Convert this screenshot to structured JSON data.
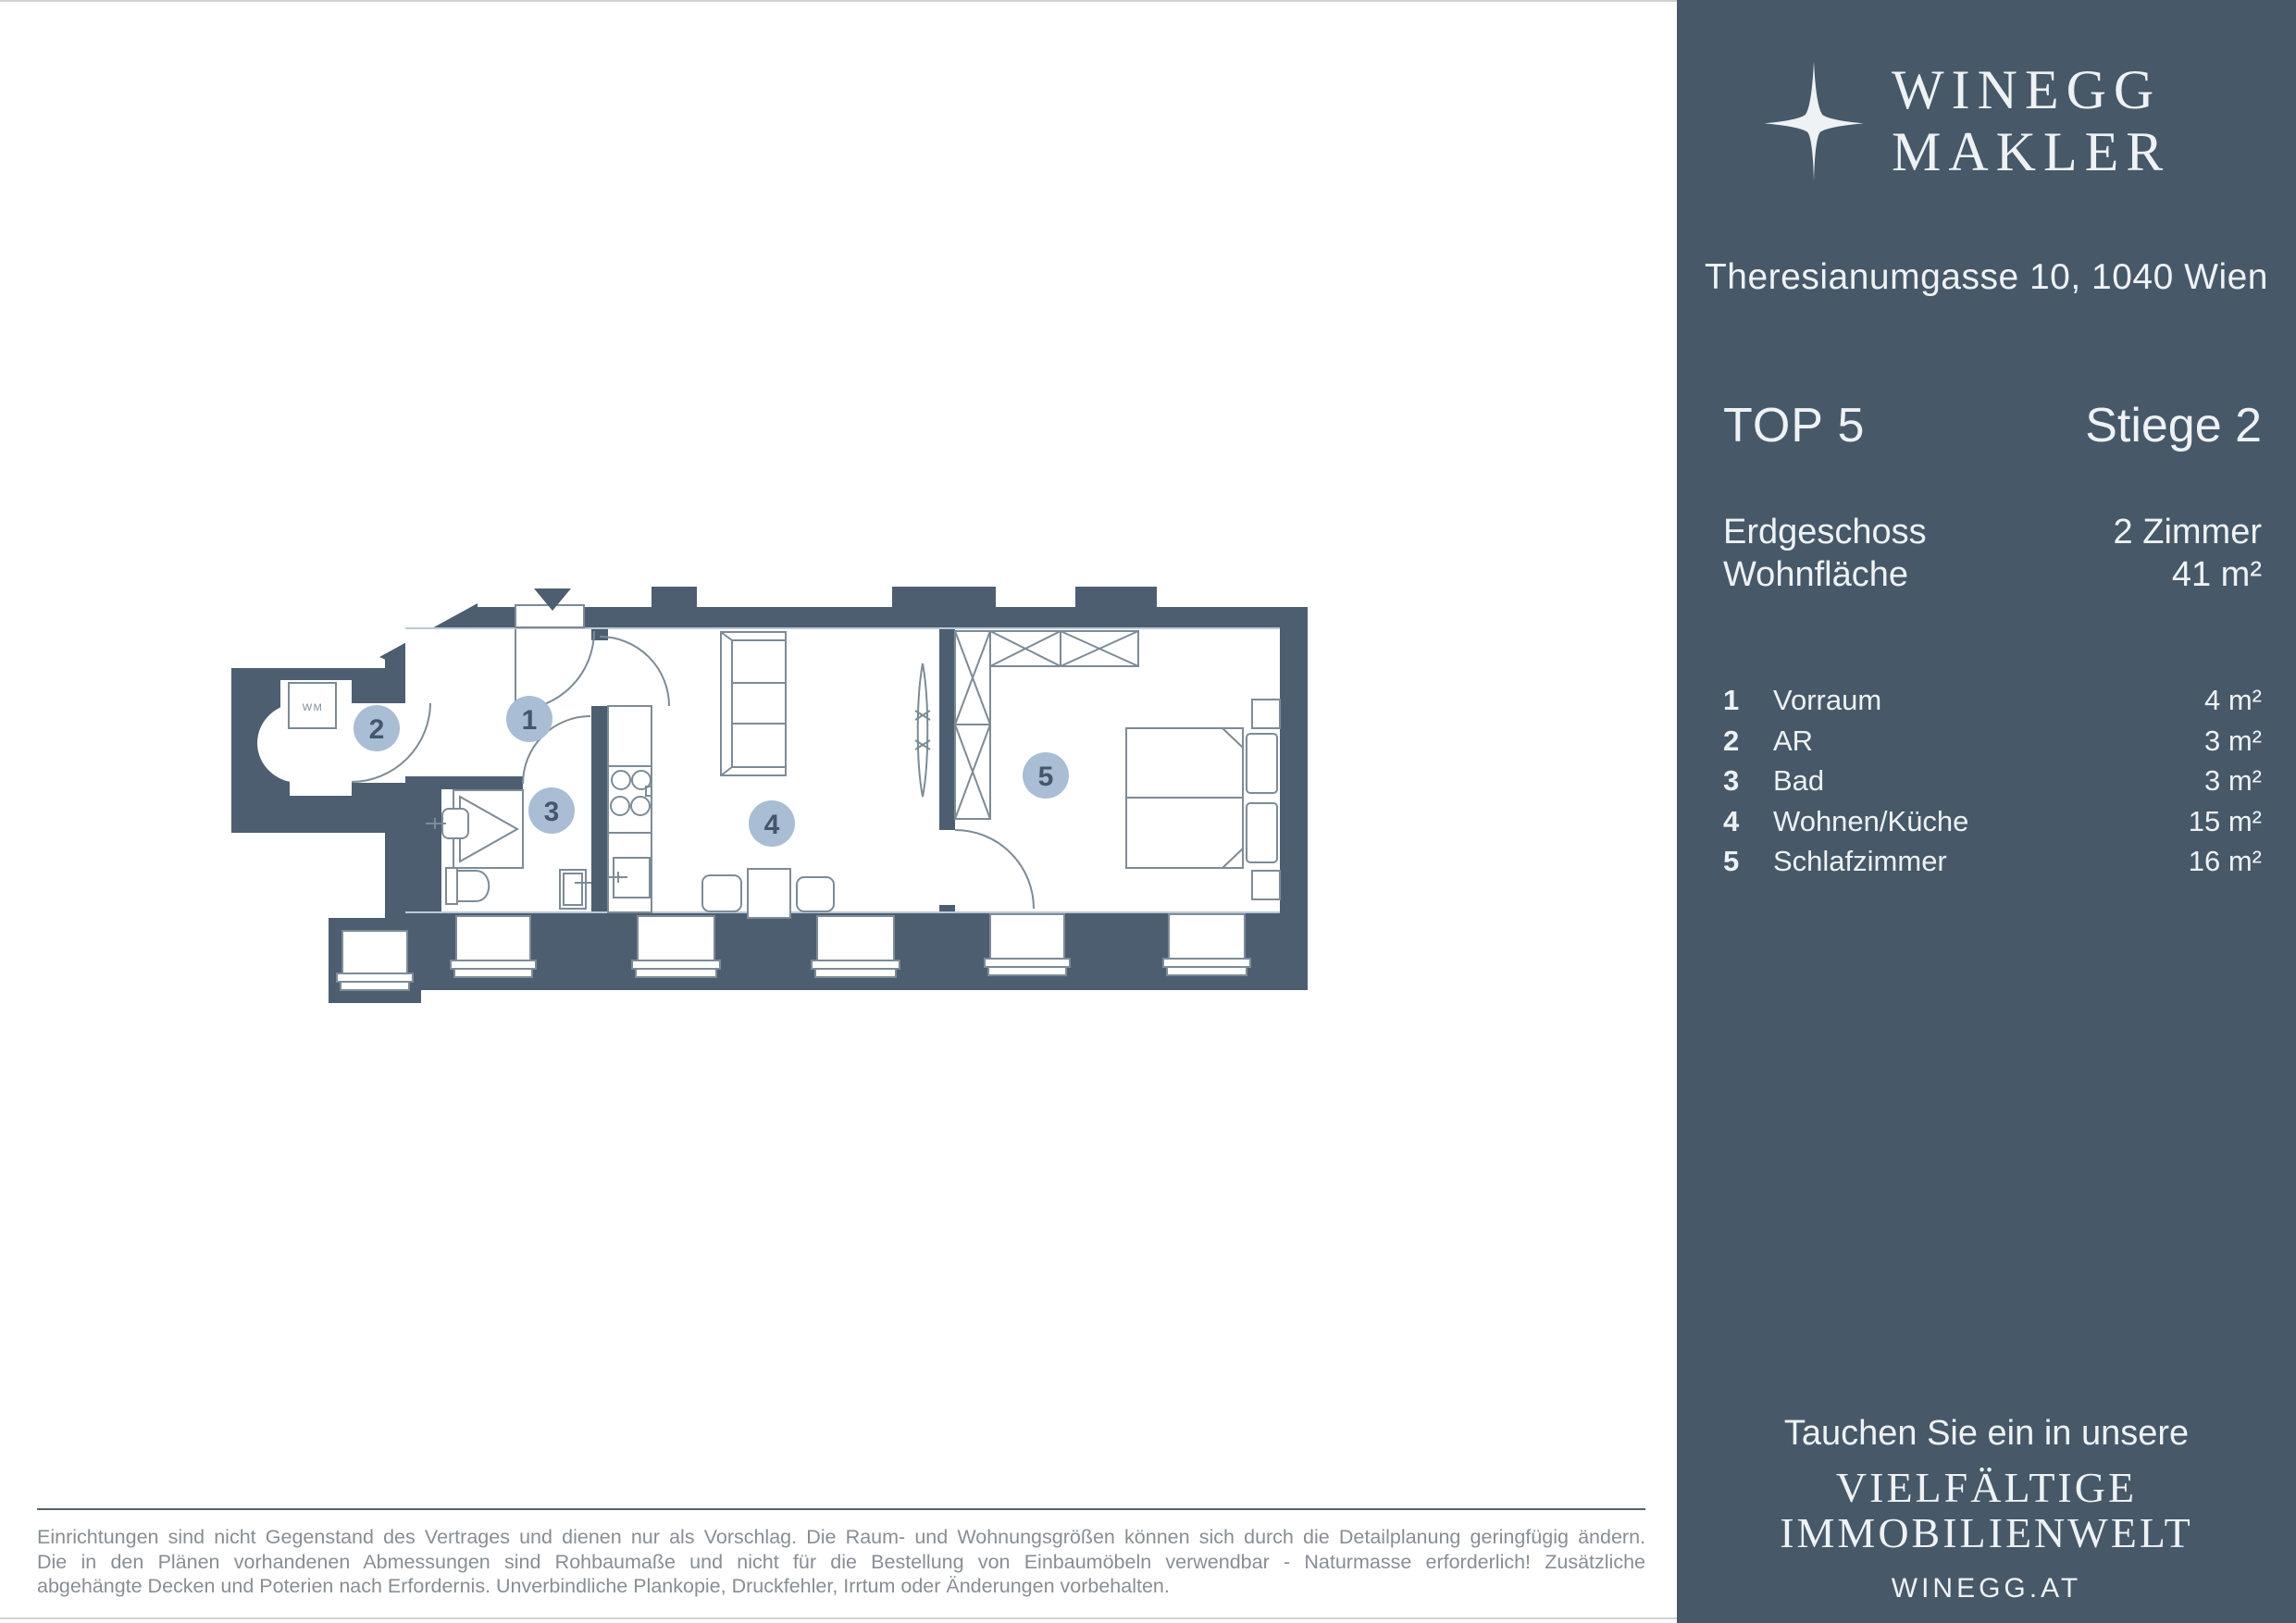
{
  "brand": {
    "name_line1": "WINEGG",
    "name_line2": "MAKLER",
    "logo_icon": "four-point-star-icon"
  },
  "sidebar": {
    "address": "Theresianumgasse 10, 1040 Wien",
    "unit_label": "TOP 5",
    "staircase_label": "Stiege 2",
    "floor_label": "Erdgeschoss",
    "floor_value": "2 Zimmer",
    "area_label": "Wohnfläche",
    "area_value": "41 m²",
    "rooms": [
      {
        "no": "1",
        "name": "Vorraum",
        "area": "4 m²"
      },
      {
        "no": "2",
        "name": "AR",
        "area": "3 m²"
      },
      {
        "no": "3",
        "name": "Bad",
        "area": "3 m²"
      },
      {
        "no": "4",
        "name": "Wohnen/Küche",
        "area": "15 m²"
      },
      {
        "no": "5",
        "name": "Schlafzimmer",
        "area": "16 m²"
      }
    ],
    "footer": {
      "tagline": "Tauchen Sie ein in unsere",
      "highlight_line1": "VIELFÄLTIGE",
      "highlight_line2": "IMMOBILIENWELT",
      "website": "WINEGG.AT"
    },
    "colors": {
      "background": "#475868",
      "text": "#eef2f5"
    }
  },
  "floorplan": {
    "badges": [
      "1",
      "2",
      "3",
      "4",
      "5"
    ],
    "wm_label": "WM",
    "colors": {
      "wall": "#4d5e71",
      "badge_fill": "#a9bdd4",
      "badge_text": "#44566a",
      "furniture_line": "#7d8b96",
      "accent_line": "#bac9d9"
    }
  },
  "disclaimer": {
    "line1": "Einrichtungen sind nicht Gegenstand des Vertrages und dienen nur als Vorschlag. Die Raum- und Wohnungsgrößen können sich durch die Detailplanung geringfügig ändern.",
    "line2": "Die in den Plänen vorhandenen Abmessungen sind Rohbaumaße und nicht für die Bestellung von Einbaumöbeln verwendbar - Naturmasse erforderlich! Zusätzliche",
    "line3": "abgehängte Decken und Poterien nach Erfordernis. Unverbindliche Plankopie, Druckfehler, Irrtum oder Änderungen vorbehalten."
  }
}
